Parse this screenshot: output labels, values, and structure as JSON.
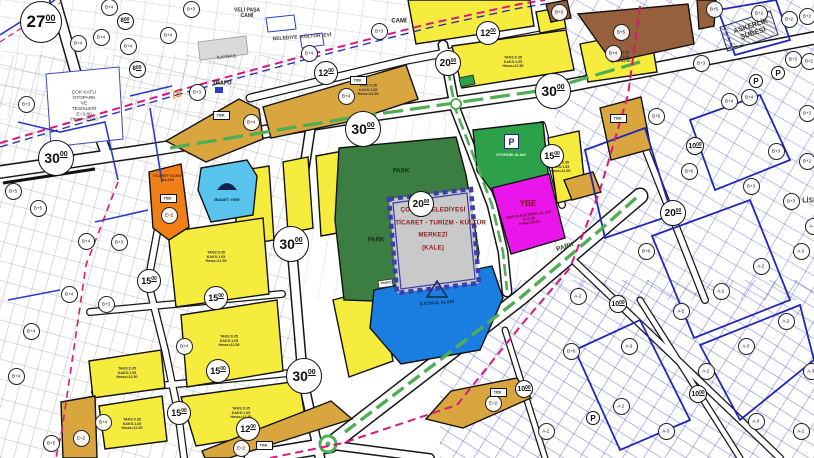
{
  "map": {
    "palette": {
      "yellow": "#f6ec3e",
      "tan": "#d8a53f",
      "brown": "#96603c",
      "orange": "#f07f18",
      "cyan": "#58c4ee",
      "park": "#3c7d42",
      "otopark": "#2da04a",
      "magenta": "#ea15ea",
      "school_blue": "#1a7de0",
      "kale_gray": "#c9c9c9",
      "kale_wall": "#3c3cae",
      "boundary": "#d8177f",
      "navy": "#2026b8",
      "road_green": "#4fae54",
      "white": "#ffffff",
      "kale_text": "#8a1f1f",
      "blue_line": "#2b3bc4"
    },
    "zone_labels": {
      "kale": [
        "ÇORUM BELEDİYESİ",
        "TİCARET - TURİZM - KÜLTÜR",
        "MERKEZİ",
        "(KALE)"
      ],
      "otopark_p": "P",
      "otopark": "OTOPARK ALANI",
      "tick": "TİCK",
      "block_note": "TAKS:0.35\nKAKS:1.05\nHmax=12.50"
    },
    "place_labels": [
      {
        "text": "VELİ PAŞA\nCAMİ",
        "x": 247,
        "y": 13,
        "s": 5,
        "rot": 0,
        "color": "#333333",
        "w": 600,
        "name": "veli-pasa-cami-label"
      },
      {
        "text": "BELEDİYE  KÜLTÜR  EVİ",
        "x": 302,
        "y": 37,
        "s": 5,
        "rot": -4,
        "color": "#444444",
        "w": 600,
        "name": "belediye-kultur-evi-label"
      },
      {
        "text": "İLKOKUL",
        "x": 227,
        "y": 57,
        "s": 4.5,
        "rot": -6,
        "color": "#555555",
        "w": 600,
        "name": "ilkokul-label"
      },
      {
        "text": "TRAFO",
        "x": 222,
        "y": 83,
        "s": 5.5,
        "rot": 0,
        "color": "#111111",
        "w": 700,
        "name": "trafo-label"
      },
      {
        "text": "CAMİ",
        "x": 399,
        "y": 21,
        "s": 6,
        "rot": 0,
        "color": "#222222",
        "w": 700,
        "name": "cami-label"
      },
      {
        "text": "ASKERLİK\nŞUBESİ",
        "x": 752,
        "y": 30,
        "s": 7,
        "rot": -18,
        "color": "#333333",
        "w": 600,
        "name": "askerlik-subesi-label"
      },
      {
        "text": "LİSE",
        "x": 810,
        "y": 201,
        "s": 7,
        "rot": 0,
        "color": "#444444",
        "w": 600,
        "name": "lise-label"
      },
      {
        "text": "(S",
        "x": 177,
        "y": 95,
        "s": 9,
        "rot": 0,
        "color": "#e6872c",
        "w": 700,
        "name": "s-boundary-label"
      },
      {
        "text": "PARK",
        "x": 401,
        "y": 171,
        "s": 6,
        "rot": 0,
        "color": "#0d330d",
        "w": 700,
        "name": "park-label"
      },
      {
        "text": "PARK",
        "x": 376,
        "y": 240,
        "s": 6,
        "rot": 0,
        "color": "#0d330d",
        "w": 700,
        "name": "park-label"
      },
      {
        "text": "PARK",
        "x": 565,
        "y": 247,
        "s": 6.5,
        "rot": -18,
        "color": "#234d23",
        "w": 700,
        "name": "park-label"
      },
      {
        "text": "ÇOK KATLI\nOTOPARK\nVE\nTESİSLERİ\nE=3.80\nHmax=15.50",
        "x": 84,
        "y": 106,
        "s": 4.8,
        "rot": 0,
        "color": "#333333",
        "w": 500,
        "name": "cok-katli-otopark-label"
      },
      {
        "text": "İBADET YERİ",
        "x": 227,
        "y": 200,
        "s": 4,
        "rot": 0,
        "color": "#102238",
        "w": 600,
        "name": "ibadet-yeri-label"
      },
      {
        "text": "İLKOKUL ALANI",
        "x": 437,
        "y": 303,
        "s": 4.5,
        "rot": -4,
        "color": "#0a2a52",
        "w": 700,
        "name": "ilkokul-alani-label"
      },
      {
        "text": "OTOPARK ALANI",
        "x": 511,
        "y": 155,
        "s": 3.6,
        "rot": 0,
        "color": "#eaffea",
        "w": 600,
        "name": "otopark-alani-label"
      },
      {
        "text": "YBE",
        "x": 528,
        "y": 204,
        "s": 8,
        "rot": 0,
        "color": "#7a1212",
        "w": 700,
        "name": "ybe-label"
      },
      {
        "text": "SOSYO-KÜLTÜREL ALANI\nE=1.00\nHmax=15.50",
        "x": 529,
        "y": 219,
        "s": 3.6,
        "rot": -8,
        "color": "#5a0b0b",
        "w": 600,
        "name": "ybe-detail-label"
      },
      {
        "text": "TİCARET KONUT\nALANI",
        "x": 168,
        "y": 178,
        "s": 3.8,
        "rot": 0,
        "color": "#5a2d00",
        "w": 600,
        "name": "ticaret-konut-label"
      },
      {
        "text": "TRAFO",
        "x": 386,
        "y": 283,
        "s": 3.2,
        "rot": -6,
        "color": "#222222",
        "w": 600,
        "name": "trafo2-label"
      }
    ],
    "road_circles": [
      {
        "x": 40,
        "y": 21,
        "main": "27",
        "sup": "00",
        "d": 40
      },
      {
        "x": 55,
        "y": 157,
        "main": "30",
        "sup": "00",
        "d": 34
      },
      {
        "x": 362,
        "y": 128,
        "main": "30",
        "sup": "00",
        "d": 34
      },
      {
        "x": 552,
        "y": 90,
        "main": "30",
        "sup": "00",
        "d": 34
      },
      {
        "x": 290,
        "y": 243,
        "main": "30",
        "sup": "00",
        "d": 34
      },
      {
        "x": 303,
        "y": 375,
        "main": "30",
        "sup": "00",
        "d": 34
      },
      {
        "x": 447,
        "y": 62,
        "main": "20",
        "sup": "00",
        "d": 24
      },
      {
        "x": 420,
        "y": 203,
        "main": "20",
        "sup": "00",
        "d": 24
      },
      {
        "x": 672,
        "y": 212,
        "main": "20",
        "sup": "00",
        "d": 24
      },
      {
        "x": 325,
        "y": 72,
        "main": "12",
        "sup": "00",
        "d": 22
      },
      {
        "x": 487,
        "y": 32,
        "main": "12",
        "sup": "00",
        "d": 22
      },
      {
        "x": 247,
        "y": 428,
        "main": "12",
        "sup": "00",
        "d": 22
      },
      {
        "x": 551,
        "y": 155,
        "main": "15",
        "sup": "00",
        "d": 22
      },
      {
        "x": 215,
        "y": 297,
        "main": "15",
        "sup": "00",
        "d": 22
      },
      {
        "x": 148,
        "y": 280,
        "main": "15",
        "sup": "00",
        "d": 22
      },
      {
        "x": 217,
        "y": 370,
        "main": "15",
        "sup": "00",
        "d": 22
      },
      {
        "x": 178,
        "y": 412,
        "main": "15",
        "sup": "00",
        "d": 22
      },
      {
        "x": 124,
        "y": 20,
        "main": "8",
        "sup": "00",
        "d": 15
      },
      {
        "x": 136,
        "y": 68,
        "main": "8",
        "sup": "00",
        "d": 15
      },
      {
        "x": 617,
        "y": 303,
        "main": "10",
        "sup": "00",
        "d": 16
      },
      {
        "x": 697,
        "y": 393,
        "main": "10",
        "sup": "00",
        "d": 16
      },
      {
        "x": 523,
        "y": 388,
        "main": "10",
        "sup": "00",
        "d": 16
      },
      {
        "x": 694,
        "y": 145,
        "main": "10",
        "sup": "00",
        "d": 16
      }
    ],
    "p_circles": [
      {
        "x": 755,
        "y": 80
      },
      {
        "x": 777,
        "y": 72
      },
      {
        "x": 592,
        "y": 417
      }
    ],
    "height_circles": [
      {
        "x": 108,
        "y": 6,
        "label": "B+4"
      },
      {
        "x": 190,
        "y": 8,
        "label": "B+3"
      },
      {
        "x": 77,
        "y": 42,
        "label": "B+4"
      },
      {
        "x": 100,
        "y": 36,
        "label": "B+4"
      },
      {
        "x": 127,
        "y": 45,
        "label": "B+4"
      },
      {
        "x": 167,
        "y": 34,
        "label": "B+4"
      },
      {
        "x": 25,
        "y": 103,
        "label": "B+3"
      },
      {
        "x": 196,
        "y": 91,
        "label": "B+3"
      },
      {
        "x": 12,
        "y": 190,
        "label": "B+5"
      },
      {
        "x": 37,
        "y": 207,
        "label": "B+5"
      },
      {
        "x": 85,
        "y": 240,
        "label": "B+4"
      },
      {
        "x": 118,
        "y": 241,
        "label": "B+3"
      },
      {
        "x": 68,
        "y": 293,
        "label": "B+4"
      },
      {
        "x": 105,
        "y": 303,
        "label": "B+3"
      },
      {
        "x": 30,
        "y": 330,
        "label": "B+4"
      },
      {
        "x": 183,
        "y": 345,
        "label": "B+4"
      },
      {
        "x": 15,
        "y": 375,
        "label": "B+4"
      },
      {
        "x": 102,
        "y": 421,
        "label": "B+4"
      },
      {
        "x": 50,
        "y": 442,
        "label": "B+5"
      },
      {
        "x": 308,
        "y": 52,
        "label": "B+4"
      },
      {
        "x": 378,
        "y": 30,
        "label": "B+3"
      },
      {
        "x": 345,
        "y": 95,
        "label": "B+4"
      },
      {
        "x": 250,
        "y": 121,
        "label": "B+4"
      },
      {
        "x": 612,
        "y": 52,
        "label": "B+4"
      },
      {
        "x": 620,
        "y": 31,
        "label": "B+5"
      },
      {
        "x": 558,
        "y": 11,
        "label": "B+3"
      },
      {
        "x": 168,
        "y": 214,
        "label": "E=2"
      },
      {
        "x": 80,
        "y": 437,
        "label": "E=2"
      },
      {
        "x": 240,
        "y": 447,
        "label": "E=2"
      },
      {
        "x": 492,
        "y": 402,
        "label": "E=2"
      },
      {
        "x": 713,
        "y": 8,
        "label": "B+5"
      },
      {
        "x": 758,
        "y": 12,
        "label": "B+2"
      },
      {
        "x": 788,
        "y": 18,
        "label": "B+2"
      },
      {
        "x": 806,
        "y": 15,
        "label": "B+2"
      },
      {
        "x": 792,
        "y": 58,
        "label": "B+3"
      },
      {
        "x": 808,
        "y": 60,
        "label": "B+2"
      },
      {
        "x": 748,
        "y": 96,
        "label": "B+4"
      },
      {
        "x": 728,
        "y": 100,
        "label": "B+4"
      },
      {
        "x": 806,
        "y": 112,
        "label": "B+3"
      },
      {
        "x": 700,
        "y": 62,
        "label": "B+3"
      },
      {
        "x": 655,
        "y": 115,
        "label": "B+5"
      },
      {
        "x": 688,
        "y": 170,
        "label": "B+6"
      },
      {
        "x": 645,
        "y": 250,
        "label": "B+6"
      },
      {
        "x": 775,
        "y": 150,
        "label": "B+3"
      },
      {
        "x": 806,
        "y": 160,
        "label": "B+2"
      },
      {
        "x": 750,
        "y": 185,
        "label": "B+3"
      },
      {
        "x": 790,
        "y": 200,
        "label": "B+3"
      },
      {
        "x": 577,
        "y": 295,
        "label": "A-2"
      },
      {
        "x": 628,
        "y": 345,
        "label": "A-3"
      },
      {
        "x": 680,
        "y": 310,
        "label": "A-2"
      },
      {
        "x": 720,
        "y": 290,
        "label": "A-2"
      },
      {
        "x": 760,
        "y": 265,
        "label": "A-2"
      },
      {
        "x": 800,
        "y": 250,
        "label": "A-3"
      },
      {
        "x": 620,
        "y": 405,
        "label": "A-2"
      },
      {
        "x": 665,
        "y": 430,
        "label": "A-3"
      },
      {
        "x": 705,
        "y": 370,
        "label": "A-2"
      },
      {
        "x": 745,
        "y": 345,
        "label": "A-3"
      },
      {
        "x": 785,
        "y": 320,
        "label": "A-2"
      },
      {
        "x": 810,
        "y": 370,
        "label": "A-3"
      },
      {
        "x": 570,
        "y": 350,
        "label": "B+6"
      },
      {
        "x": 545,
        "y": 430,
        "label": "A-2"
      },
      {
        "x": 755,
        "y": 420,
        "label": "A-3"
      },
      {
        "x": 800,
        "y": 430,
        "label": "A-2"
      },
      {
        "x": 812,
        "y": 225,
        "label": "A-2"
      }
    ],
    "tick_boxes": [
      {
        "x": 220,
        "y": 114
      },
      {
        "x": 357,
        "y": 79
      },
      {
        "x": 617,
        "y": 117
      },
      {
        "x": 263,
        "y": 444
      },
      {
        "x": 167,
        "y": 197
      },
      {
        "x": 497,
        "y": 391
      }
    ],
    "block_notes": [
      {
        "x": 216,
        "y": 257
      },
      {
        "x": 229,
        "y": 341
      },
      {
        "x": 241,
        "y": 413
      },
      {
        "x": 127,
        "y": 373
      },
      {
        "x": 132,
        "y": 424
      },
      {
        "x": 513,
        "y": 62
      },
      {
        "x": 368,
        "y": 90
      },
      {
        "x": 620,
        "y": 57
      },
      {
        "x": 560,
        "y": 167
      }
    ]
  }
}
